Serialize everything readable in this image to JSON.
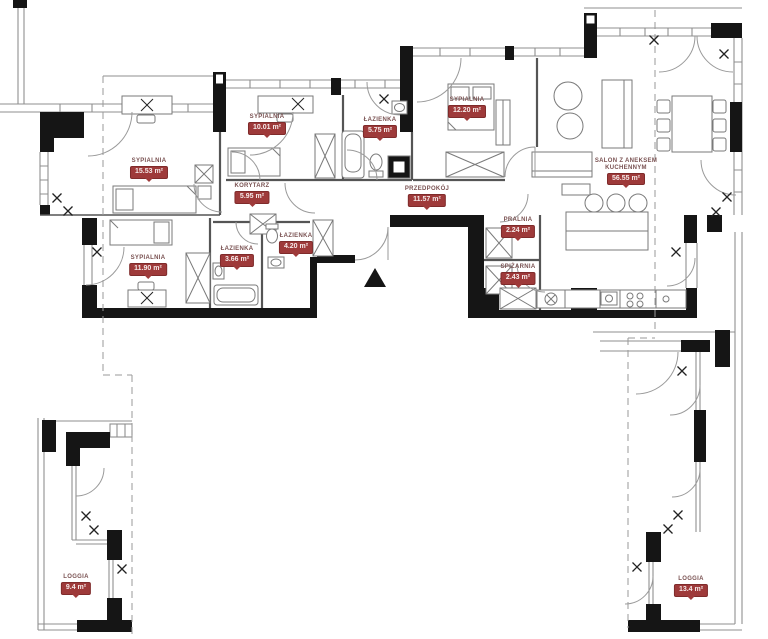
{
  "meta": {
    "drawing_type": "apartment-floor-plan",
    "language": "pl"
  },
  "colors": {
    "badge_bg": "#9e3a3a",
    "badge_border": "#7f2b2b",
    "badge_text": "#f6ebea",
    "room_name_text": "#7a5252",
    "wall": "#151515",
    "thin_line": "#8f8f8f"
  },
  "rooms": [
    {
      "id": "sypialnia-1",
      "name": "SYPIALNIA",
      "area": "15.53 m²",
      "x": 149,
      "y": 158
    },
    {
      "id": "sypialnia-2",
      "name": "SYPIALNIA",
      "area": "10.01 m²",
      "x": 267,
      "y": 114
    },
    {
      "id": "korytarz",
      "name": "KORYTARZ",
      "area": "5.95 m²",
      "x": 252,
      "y": 183
    },
    {
      "id": "lazienka-1",
      "name": "ŁAZIENKA",
      "area": "5.75 m²",
      "x": 380,
      "y": 117
    },
    {
      "id": "sypialnia-3",
      "name": "SYPIALNIA",
      "area": "12.20 m²",
      "x": 467,
      "y": 97
    },
    {
      "id": "przedpokoj",
      "name": "PRZEDPOKÓJ",
      "area": "11.57 m²",
      "x": 427,
      "y": 186
    },
    {
      "id": "salon",
      "name": "SALON Z ANEKSEM KUCHENNYM",
      "area": "56.55 m²",
      "x": 626,
      "y": 158
    },
    {
      "id": "pralnia",
      "name": "PRALNIA",
      "area": "2.24 m²",
      "x": 518,
      "y": 217
    },
    {
      "id": "spizarnia",
      "name": "SPIŻARNIA",
      "area": "2.43 m²",
      "x": 518,
      "y": 264
    },
    {
      "id": "sypialnia-4",
      "name": "SYPIALNIA",
      "area": "11.90 m²",
      "x": 148,
      "y": 255
    },
    {
      "id": "lazienka-2",
      "name": "ŁAZIENKA",
      "area": "3.66 m²",
      "x": 237,
      "y": 246
    },
    {
      "id": "lazienka-3",
      "name": "ŁAZIENKA",
      "area": "4.20 m²",
      "x": 296,
      "y": 233
    },
    {
      "id": "loggia-1",
      "name": "LOGGIA",
      "area": "9.4 m²",
      "x": 76,
      "y": 574
    },
    {
      "id": "loggia-2",
      "name": "LOGGIA",
      "area": "13.4 m²",
      "x": 691,
      "y": 576
    }
  ]
}
